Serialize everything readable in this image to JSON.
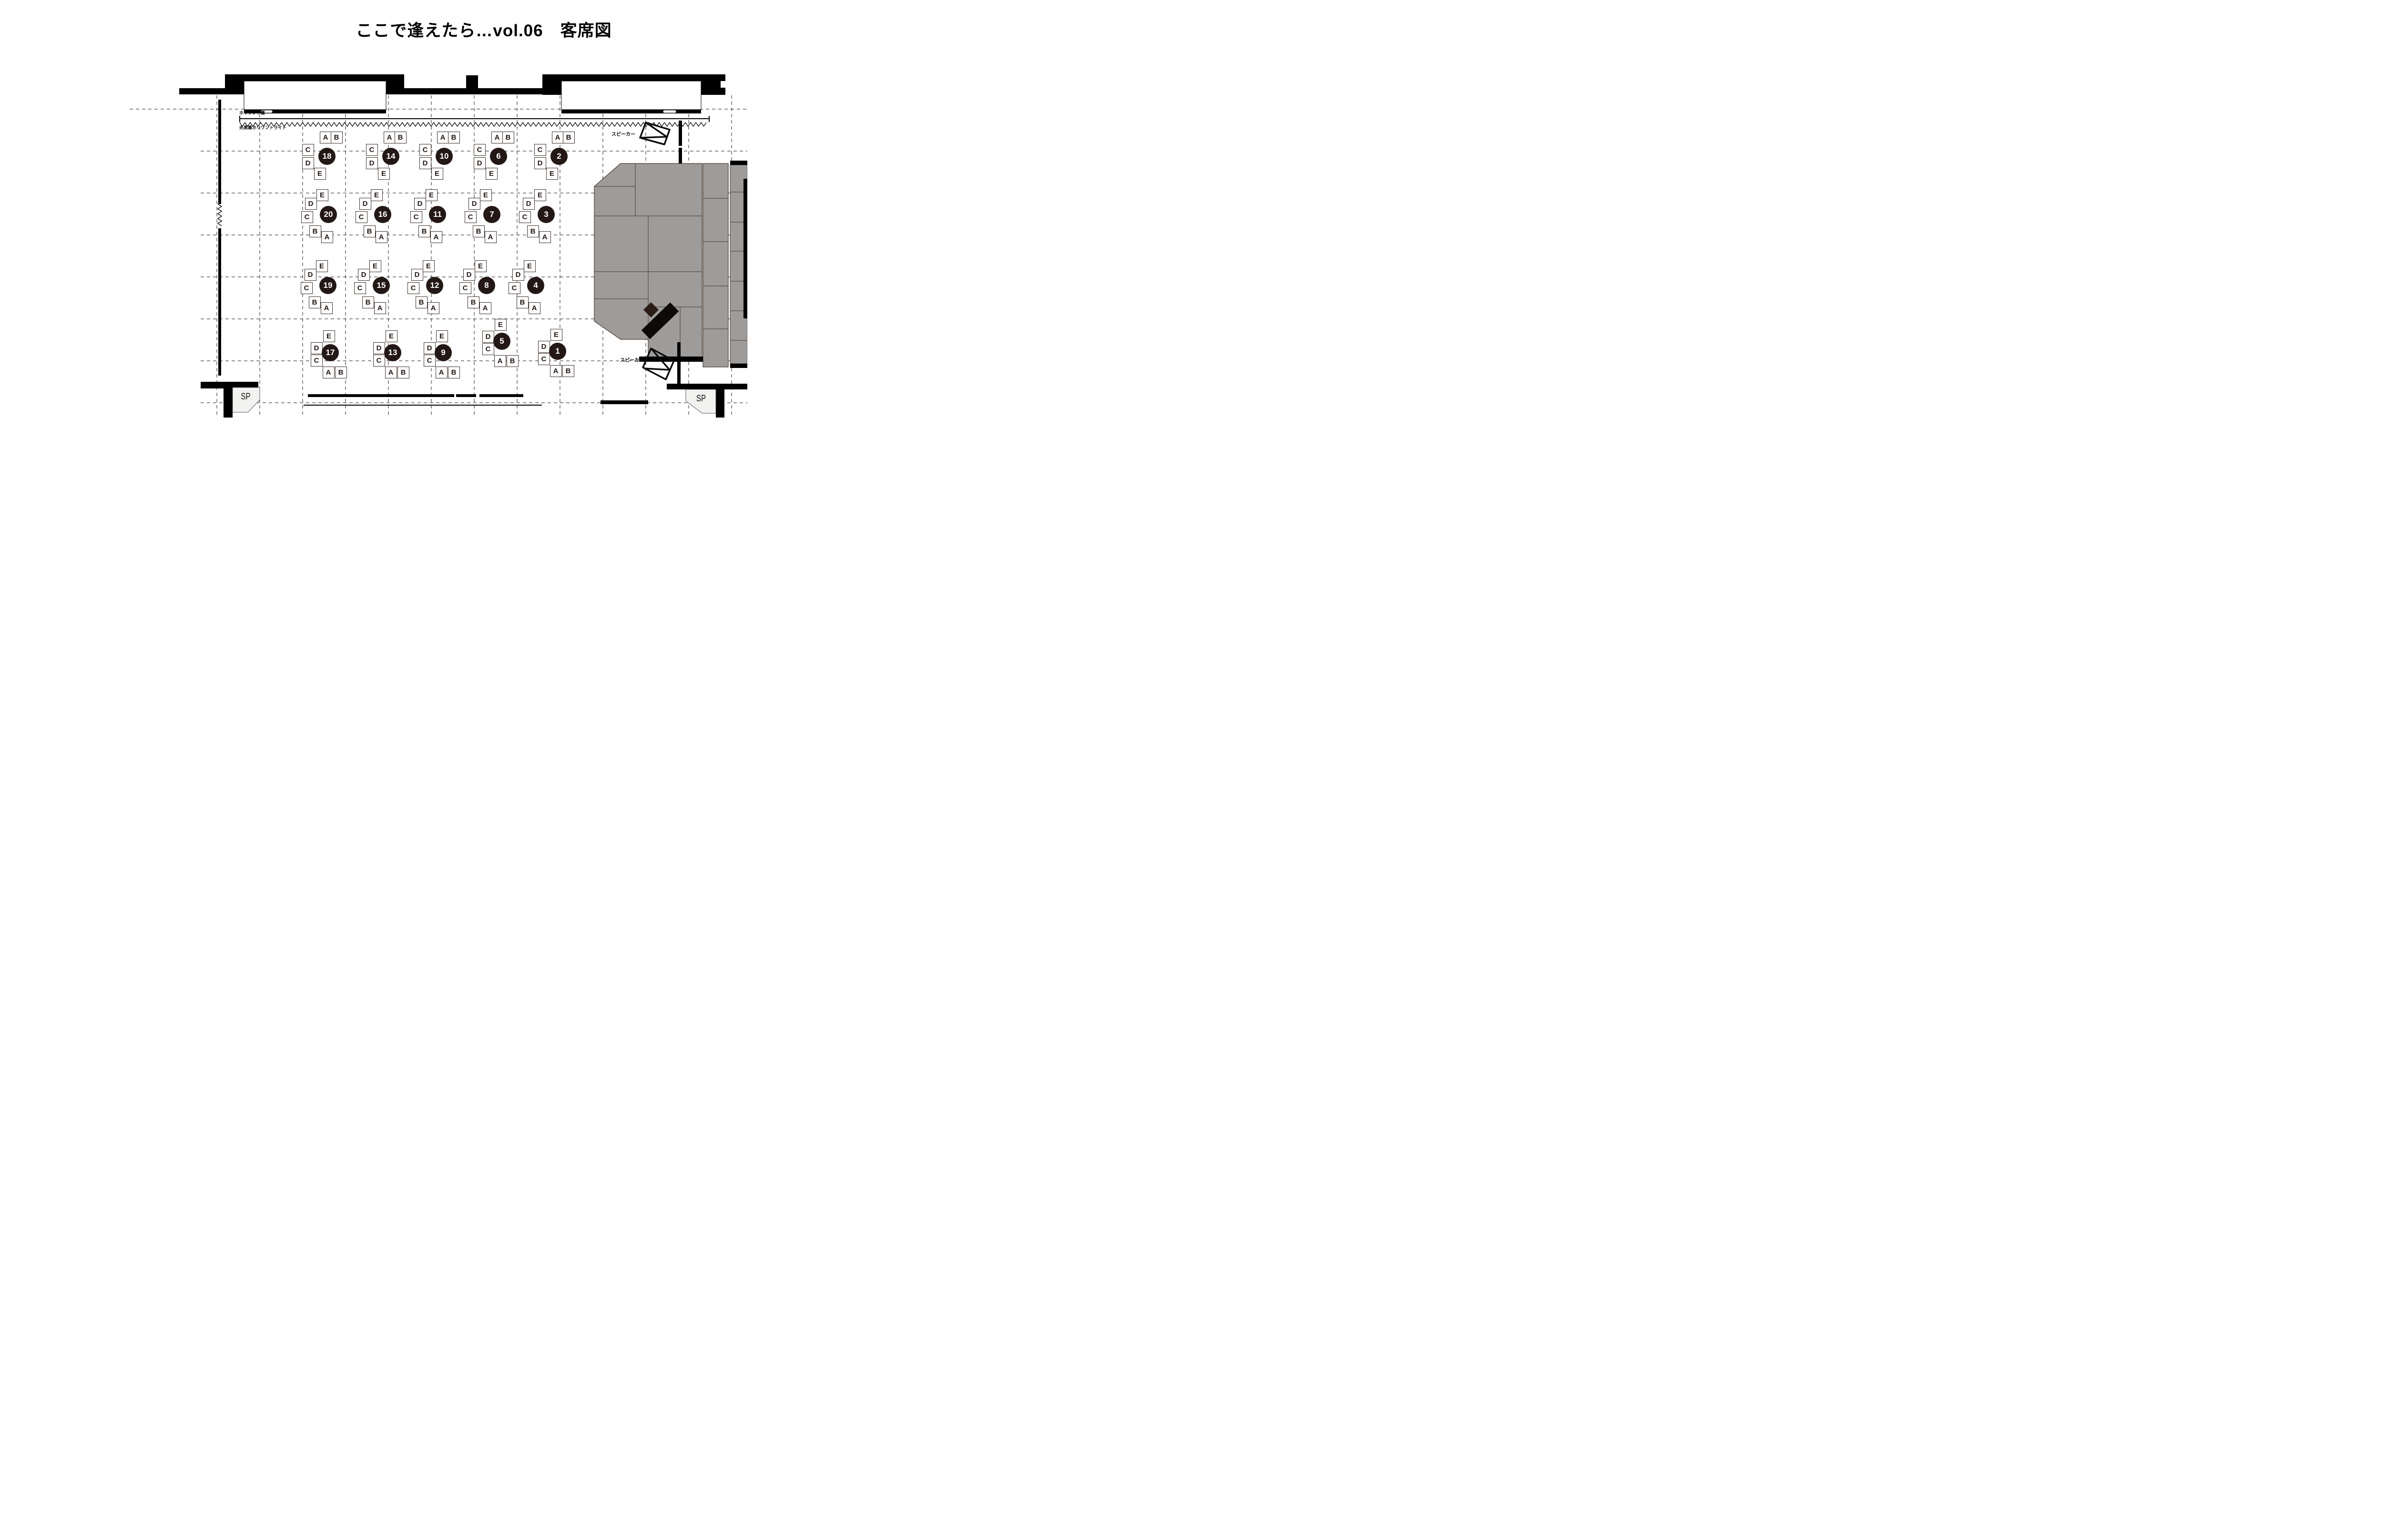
{
  "title": "ここで逢えたら…vol.06　客席図",
  "annotations": {
    "horizon_curtain": "ホリゾント幕",
    "center_black_curtain_horizon_light": "央黒幕ホリゾントライト",
    "speaker_top": "スピーカー",
    "speaker_bottom": "スピーカー",
    "sp_booth_left": "SP",
    "sp_booth_right": "SP"
  },
  "seating": {
    "seat_labels": [
      "A",
      "B",
      "C",
      "D",
      "E"
    ],
    "rows": [
      {
        "row": 1,
        "tables": [
          18,
          14,
          10,
          6,
          2
        ]
      },
      {
        "row": 2,
        "tables": [
          20,
          16,
          11,
          7,
          3
        ]
      },
      {
        "row": 3,
        "tables": [
          19,
          15,
          12,
          8,
          4
        ]
      },
      {
        "row": 4,
        "tables": [
          17,
          13,
          9,
          5,
          1
        ]
      }
    ],
    "table_count": 20
  },
  "colors": {
    "wall": "#000000",
    "ink": "#231815",
    "seat_border": "#3a2e28",
    "stage_fill": "#9e9c9a",
    "stage_line": "#46392f",
    "piano_mark": "#0c0b0a",
    "bench_mark": "#2b1c15",
    "booth_fill": "#f2f2f1",
    "dash": "#1a1a1a"
  }
}
